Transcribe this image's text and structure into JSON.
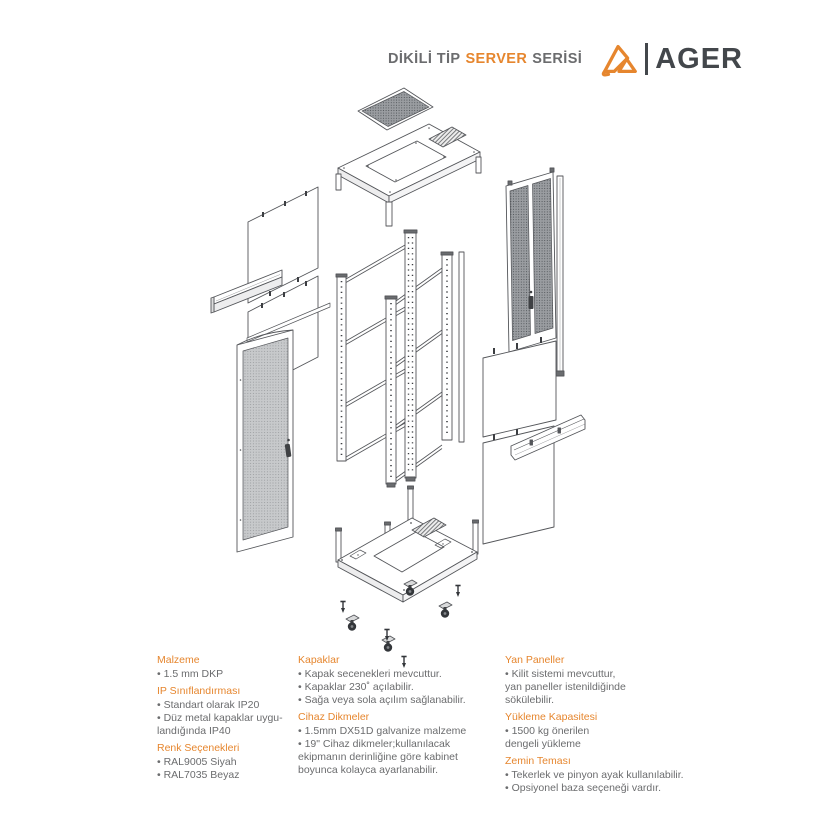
{
  "header": {
    "title_prefix": "DİKİLİ TİP",
    "title_highlight": "SERVER",
    "title_suffix": "SERİSİ",
    "brand": "AGER"
  },
  "colors": {
    "accent": "#E6862E",
    "brand_dark": "#43474B",
    "body_text": "#6B6C6E",
    "line_gray": "#54565A"
  },
  "diagram": {
    "parts": [
      "perforated-top-filter",
      "top-cover",
      "left-side-panels",
      "mounting-bracket",
      "perforated-front-door",
      "rack-frame",
      "perforated-rear-door",
      "right-side-panels",
      "base-plate",
      "casters",
      "leveling-feet"
    ]
  },
  "specs": {
    "bullet": "•",
    "columns": [
      {
        "sections": [
          {
            "heading": "Malzeme",
            "items": [
              [
                "1.5 mm DKP"
              ]
            ]
          },
          {
            "heading": "IP Sınıflandırması",
            "items": [
              [
                "Standart olarak IP20"
              ],
              [
                "Düz metal kapaklar uygu-",
                "landığında IP40"
              ]
            ]
          },
          {
            "heading": "Renk Seçenekleri",
            "items": [
              [
                "RAL9005 Siyah"
              ],
              [
                "RAL7035 Beyaz"
              ]
            ]
          }
        ]
      },
      {
        "sections": [
          {
            "heading": "Kapaklar",
            "items": [
              [
                "Kapak secenekleri mevcuttur."
              ],
              [
                "Kapaklar 230˚ açılabilir."
              ],
              [
                "Sağa veya sola açılım sağlanabilir."
              ]
            ]
          },
          {
            "heading": "Cihaz Dikmeler",
            "items": [
              [
                "1.5mm DX51D galvanize malzeme"
              ],
              [
                "19\" Cihaz dikmeler;kullanılacak",
                "ekipmanın derinliğine göre kabinet",
                "boyunca kolayca ayarlanabilir."
              ]
            ]
          }
        ]
      },
      {
        "sections": [
          {
            "heading": "Yan Paneller",
            "items": [
              [
                "Kilit sistemi mevcuttur,",
                "yan paneller istenildiğinde",
                "sökülebilir."
              ]
            ]
          },
          {
            "heading": "Yükleme Kapasitesi",
            "items": [
              [
                "1500 kg önerilen",
                "dengeli yükleme"
              ]
            ]
          },
          {
            "heading": "Zemin Teması",
            "items": [
              [
                "Tekerlek ve pinyon ayak kullanılabilir."
              ],
              [
                "Opsiyonel baza seçeneği vardır."
              ]
            ]
          }
        ]
      }
    ]
  }
}
